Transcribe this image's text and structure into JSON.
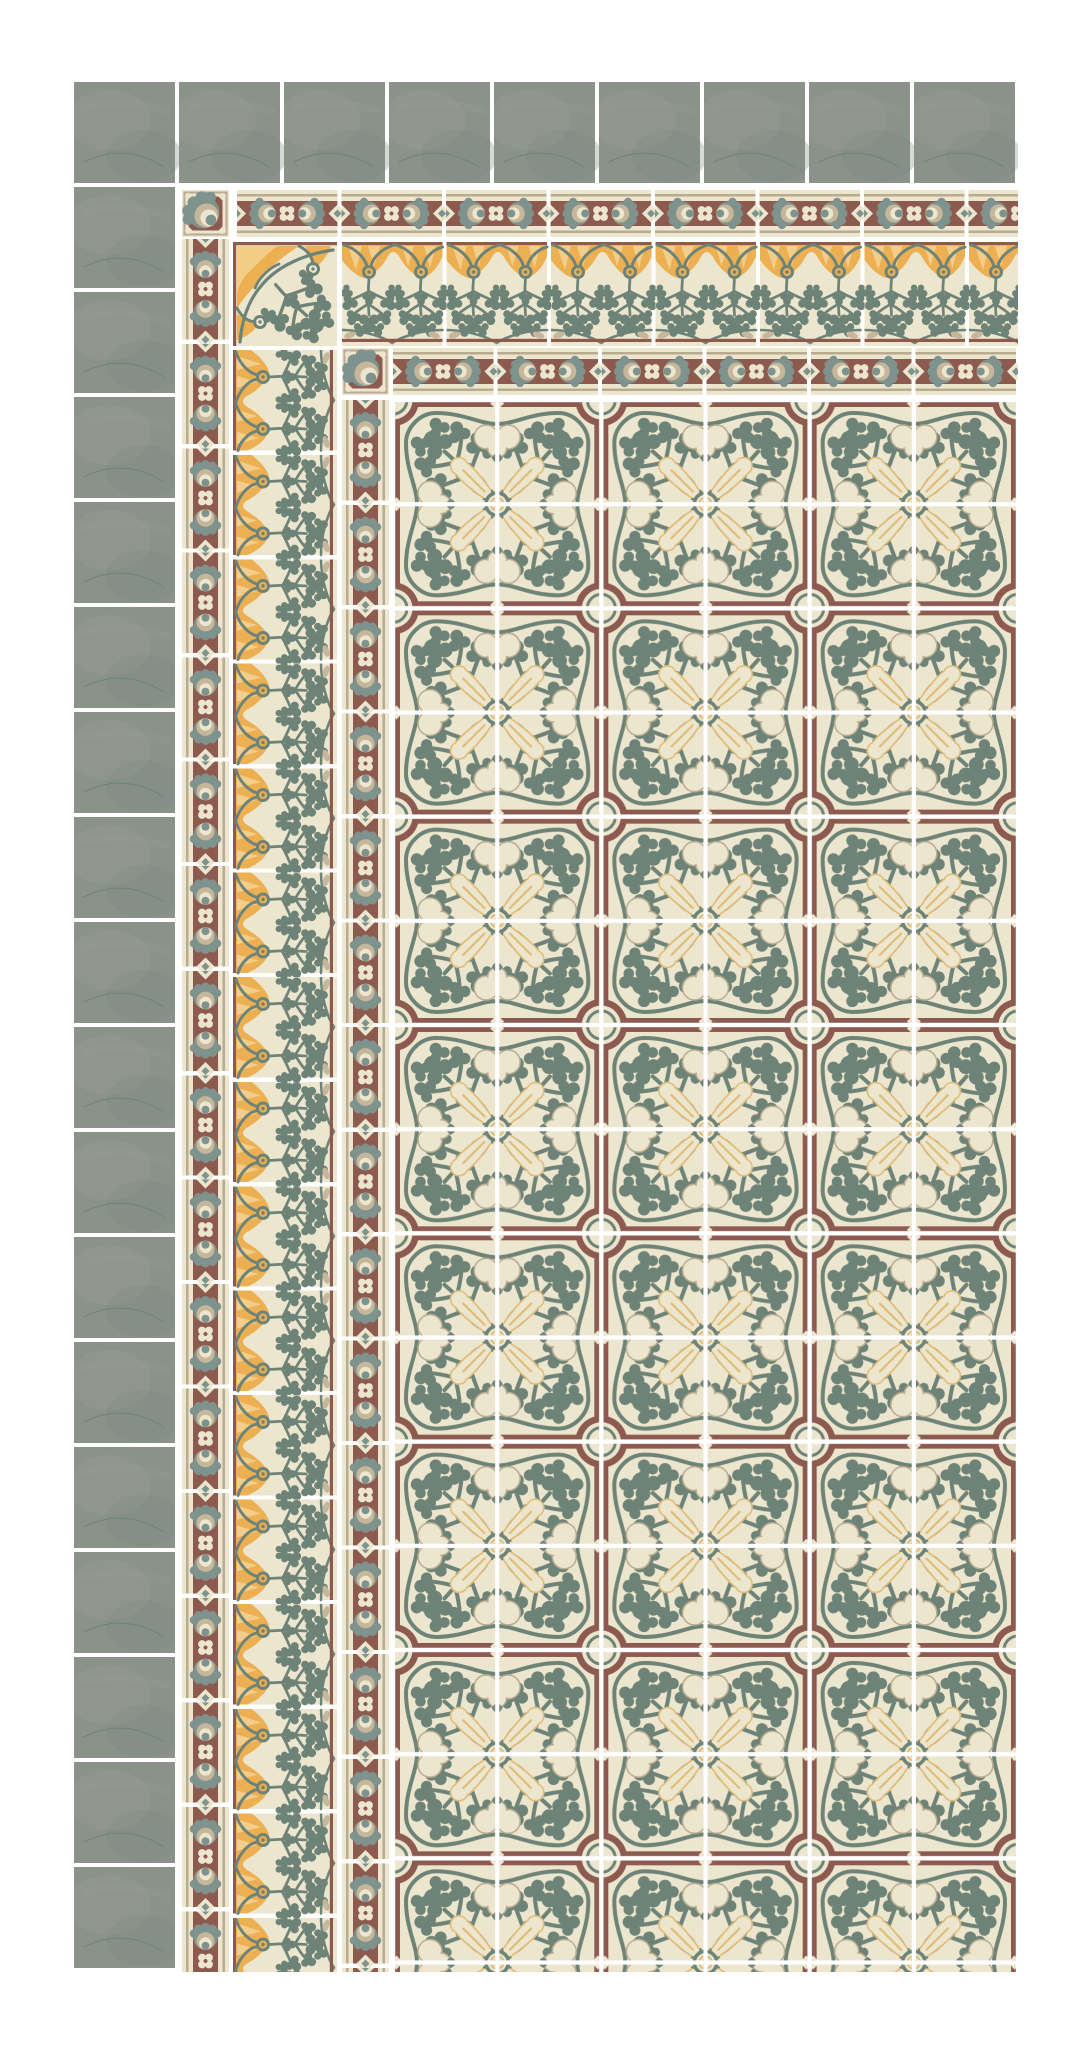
{
  "scene": {
    "kind": "cement-tile-floor-layout-preview",
    "regions": {
      "plain_edge": "plain sage green edge tiles",
      "outer_border": "narrow medallion border strip",
      "frieze": "art-nouveau foliage frieze border",
      "inner_border": "narrow medallion border strip",
      "field": "foliate ornament patterned field"
    }
  },
  "palette": {
    "page_bg": "#ffffff",
    "grout": "#ffffff",
    "sage": "#8a928a",
    "sage_light": "#969c93",
    "sage_dark": "#7e8a80",
    "cream": "#ede6ce",
    "maroon": "#8d5a50",
    "maroon_dark": "#6f4b43",
    "slate": "#6e8377",
    "slate_soft": "#7e928e",
    "tan": "#c6b79b",
    "tan_line": "#b9ab90",
    "gold": "#dfbc78",
    "yellow": "#ecb052",
    "yellow_light": "#f5d494"
  },
  "layout": {
    "canvas": {
      "width": 1092,
      "height": 2048
    },
    "composition": {
      "left": 74,
      "top": 82,
      "right": 1018,
      "bottom": 1972
    },
    "green_row": {
      "width": 944,
      "height": 101
    },
    "green_col": {
      "width": 101,
      "height": 1785
    },
    "strip1_h": {
      "width": 781,
      "height": 47
    },
    "strip1_v": {
      "width": 1733,
      "height": 47
    },
    "frieze_h": {
      "width": 676,
      "height": 104
    },
    "frieze_v": {
      "width": 1622,
      "height": 104
    },
    "strip2_h": {
      "width": 625,
      "height": 47
    },
    "strip2_v": {
      "width": 1572,
      "height": 47
    },
    "field": {
      "width": 625,
      "height": 1572
    },
    "corner_small": {
      "size": 47
    },
    "corner_frieze": {
      "size": 104
    }
  },
  "tiles": {
    "plain_green": {
      "count_top_row": 9,
      "count_left_column": 18,
      "module_px": 105
    },
    "border_medallion": {
      "strip_height_px": 47,
      "tile_length_px": 104
    },
    "frieze": {
      "tile_px": 104
    },
    "field_pattern": {
      "unit_px": 208,
      "unit_columns": 3,
      "unit_rows_visible": 7.5
    }
  }
}
